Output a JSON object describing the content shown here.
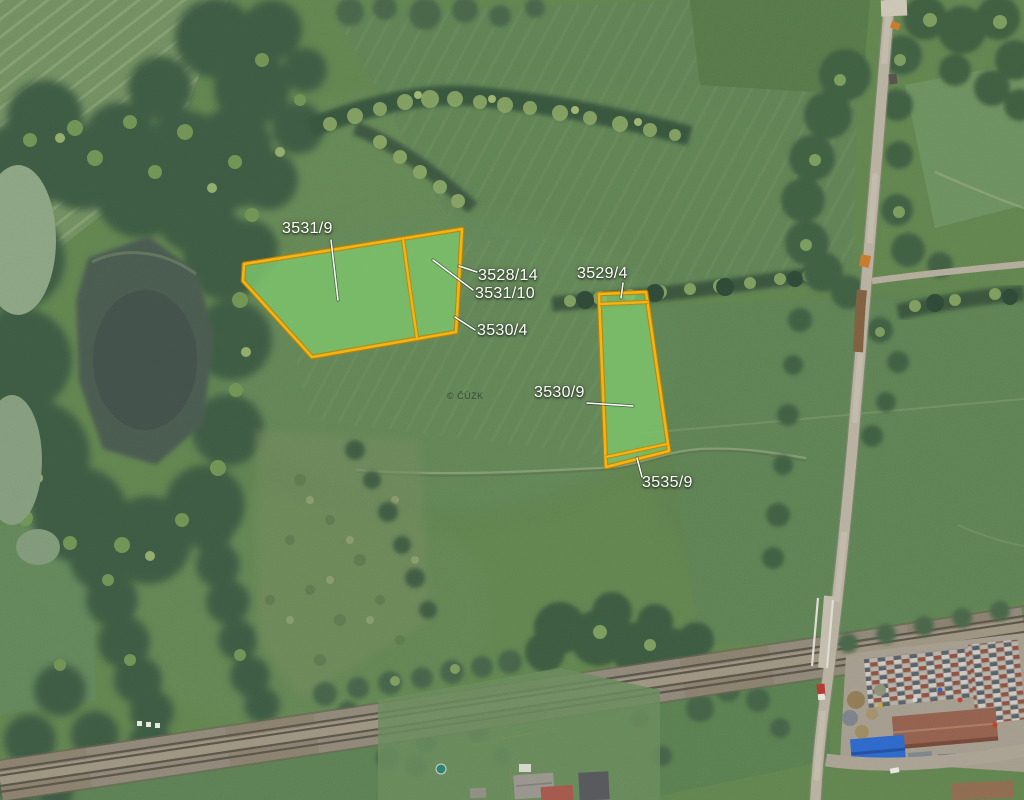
{
  "map": {
    "source_watermark": "© ČÚZK",
    "colors": {
      "highlight_fill": "#7CC36B",
      "highlight_border": "#F5B315",
      "label_color": "#FFFFFF"
    },
    "parcels": [
      {
        "id": "3531-9",
        "label": "3531/9"
      },
      {
        "id": "3528-14",
        "label": "3528/14"
      },
      {
        "id": "3531-10",
        "label": "3531/10"
      },
      {
        "id": "3530-4",
        "label": "3530/4"
      },
      {
        "id": "3529-4",
        "label": "3529/4"
      },
      {
        "id": "3530-9",
        "label": "3530/9"
      },
      {
        "id": "3535-9",
        "label": "3535/9"
      }
    ]
  }
}
